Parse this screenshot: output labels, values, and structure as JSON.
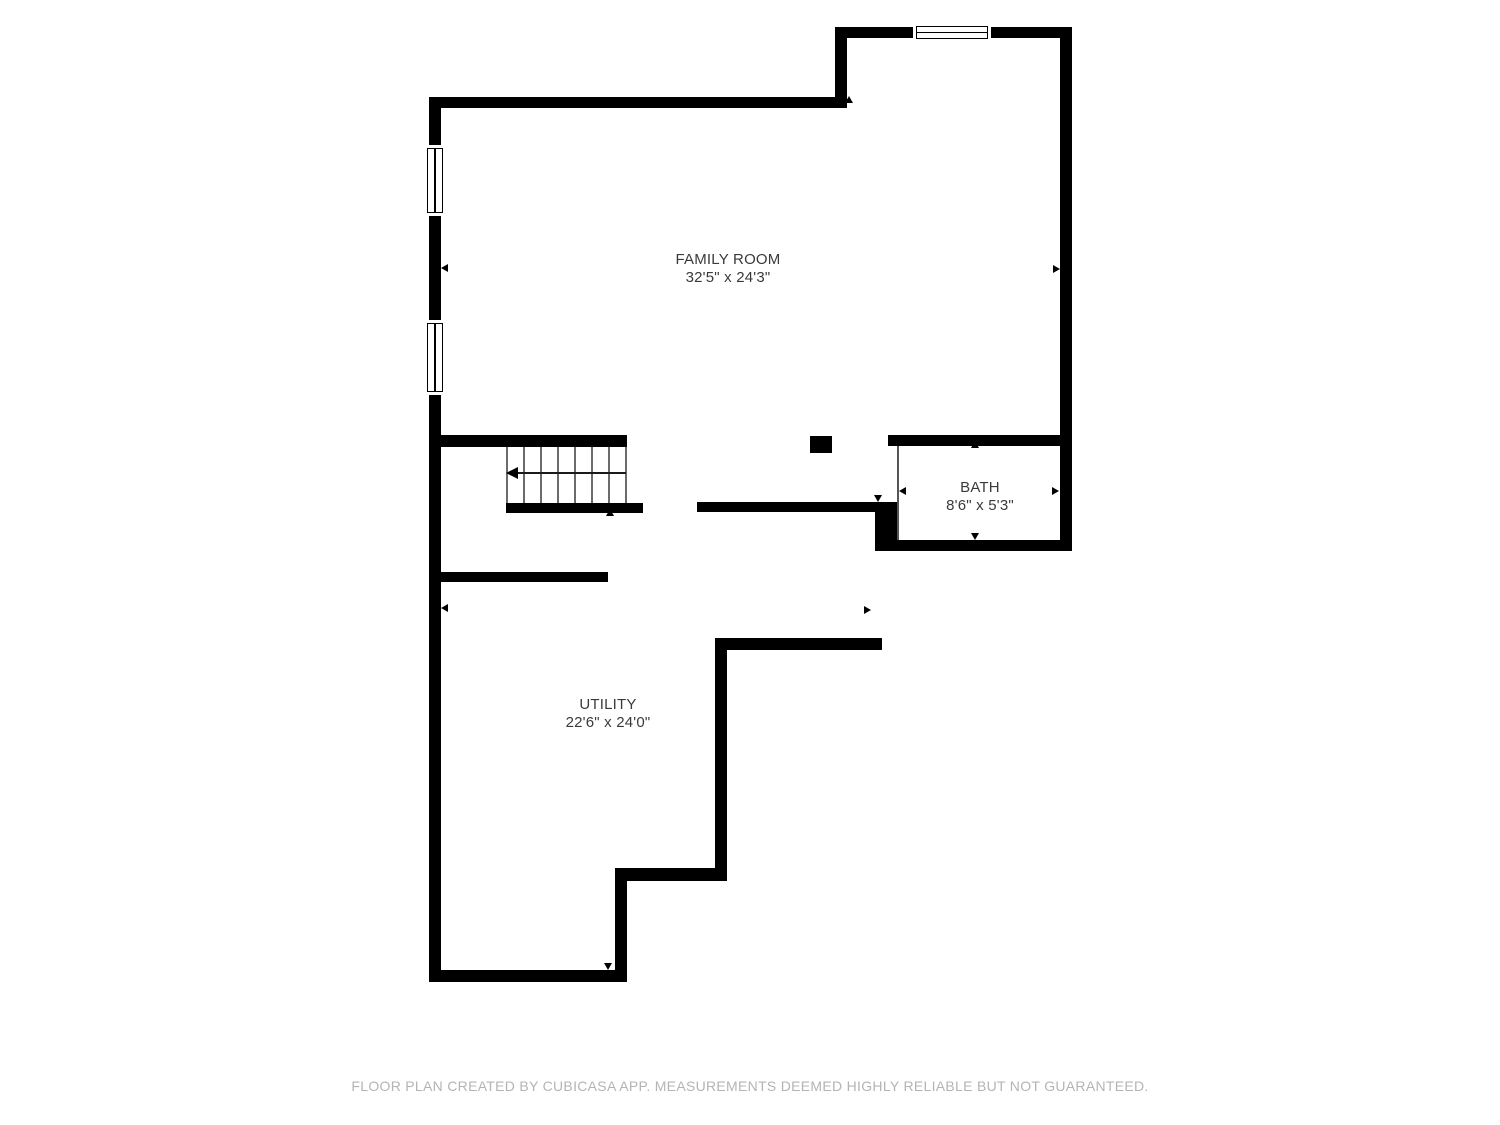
{
  "plan": {
    "rooms": [
      {
        "id": "family-room",
        "name": "FAMILY ROOM",
        "dims": "32'5\" x 24'3\""
      },
      {
        "id": "bath",
        "name": "BATH",
        "dims": "8'6\" x 5'3\""
      },
      {
        "id": "utility",
        "name": "UTILITY",
        "dims": "22'6\" x 24'0\""
      }
    ],
    "features": {
      "staircase": "stairs with down direction arrow",
      "windows": 3,
      "column": "square structural post in family room"
    },
    "colors": {
      "wall": "#000000",
      "room_label": "#3a3a3a",
      "footer_text": "#b4b4b4",
      "background": "#ffffff"
    },
    "footer_text": "FLOOR PLAN CREATED BY CUBICASA APP. MEASUREMENTS DEEMED HIGHLY RELIABLE BUT NOT GUARANTEED."
  }
}
